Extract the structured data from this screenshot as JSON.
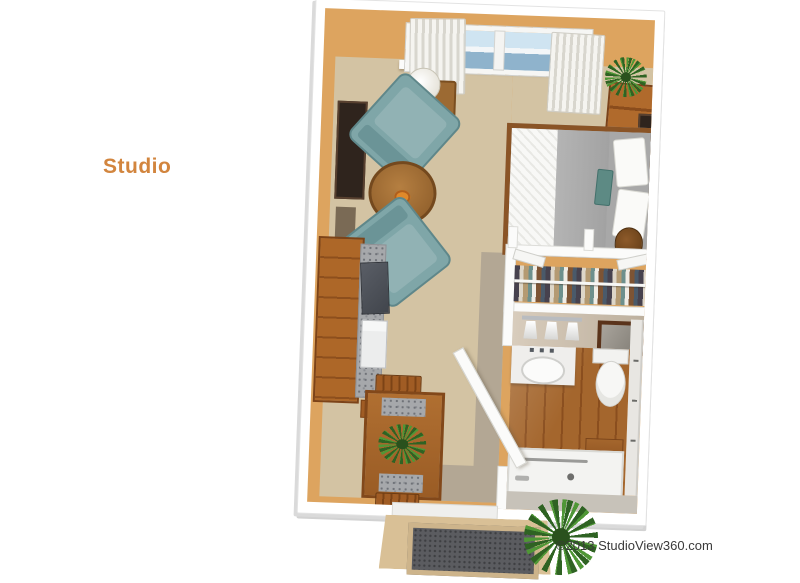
{
  "page": {
    "title_label": "Studio",
    "copyright": "©2013 StudioView360.com",
    "background_color": "#ffffff"
  },
  "palette": {
    "label_orange": "#d2853e",
    "copyright_gray": "#3a3a3a",
    "wall_face_tan": "#dda45f",
    "wall_top_white": "#ffffff",
    "carpet_beige": "#d3c3a3",
    "vinyl_gray": "#b3a794",
    "bathroom_wood_brown": "#9d5f28",
    "armchair_teal": "#7fa6a8",
    "bed_duvet_gray": "#aeaeae",
    "accent_pillow_teal": "#5d8a84",
    "cabinet_wood": "#ab6727",
    "granite_counter_gray": "#a6a8ab",
    "window_sky_blue": "#b9d5e8",
    "curtain_white": "#f5f4f0",
    "plant_green": "#3f7d2e",
    "landing_tan": "#d9c096",
    "doormat_gray": "#5b5c60"
  },
  "floorplan": {
    "view": "3d-top-down-studio-apartment",
    "areas": [
      "living-sleeping-area",
      "kitchenette",
      "dining-nook",
      "closet",
      "bathroom",
      "entry-porch"
    ],
    "furniture": [
      "window-with-curtains",
      "table-lamp",
      "two-armchairs",
      "round-coffee-table",
      "wall-art",
      "media-dresser",
      "potted-plants",
      "bed-with-pillows",
      "nightstand",
      "kitchen-cabinets",
      "granite-counter",
      "range",
      "refrigerator",
      "dining-table-with-chairs",
      "hanging-clothes-rod",
      "bifold-closet-doors",
      "vanity-light-fixture",
      "vanity-sink",
      "framed-picture",
      "toilet",
      "shower",
      "entry-door",
      "doormat"
    ]
  }
}
